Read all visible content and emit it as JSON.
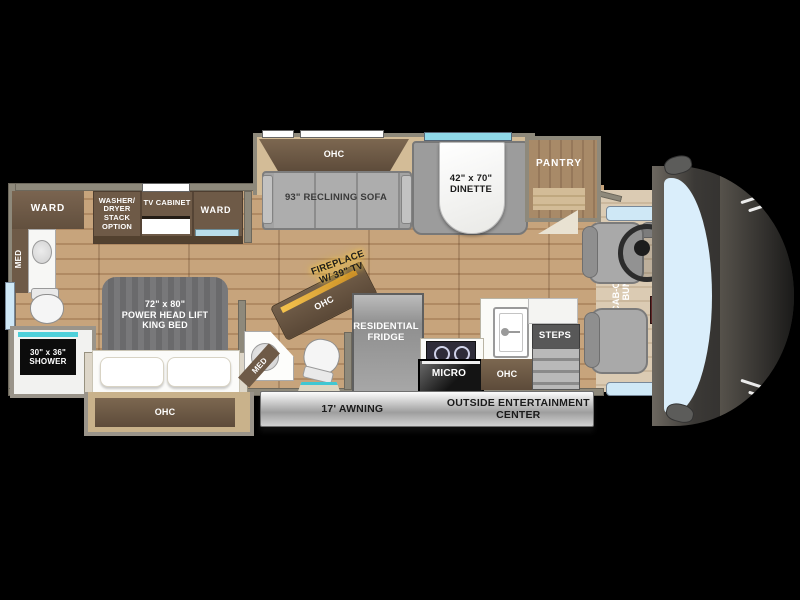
{
  "labels": {
    "bedroom": {
      "ward_left": "WARD",
      "med_left": "MED",
      "washer_dryer": "WASHER/\nDRYER\nSTACK\nOPTION",
      "tv_cabinet": "TV CABINET",
      "ward_right": "WARD",
      "bed": "72\" x 80\"\nPOWER HEAD LIFT\nKING BED",
      "bed_ohc": "OHC",
      "shower": "30\" x 36\"\nSHOWER"
    },
    "bathroom": {
      "med_mid": "MED"
    },
    "living": {
      "sofa_ohc": "OHC",
      "sofa": "93\" RECLINING SOFA",
      "dinette": "42\" x 70\"\nDINETTE",
      "pantry": "PANTRY",
      "fireplace": "FIREPLACE\nW/ 39\" TV",
      "fireplace_ohc": "OHC"
    },
    "kitchen": {
      "fridge": "RESIDENTIAL\nFRIDGE",
      "micro": "MICRO",
      "ohc": "OHC",
      "steps": "STEPS"
    },
    "cab": {
      "bunk": "CAB-OVER\nBUNK"
    },
    "exterior": {
      "awning": "17' AWNING",
      "entertainment": "OUTSIDE ENTERTAINMENT\nCENTER"
    }
  },
  "colors": {
    "background": "#000000",
    "floor_wood": "#c7a47c",
    "cabinet_wood": "#6e5a47",
    "wall_gray": "#8e897b",
    "upholstery_gray": "#a3a3a3",
    "window_teal": "#8fd8e8",
    "window_blue": "#cfe8f6",
    "fireplace_glow": "#ffc13a",
    "awning_gray": "#9e9e9e"
  }
}
